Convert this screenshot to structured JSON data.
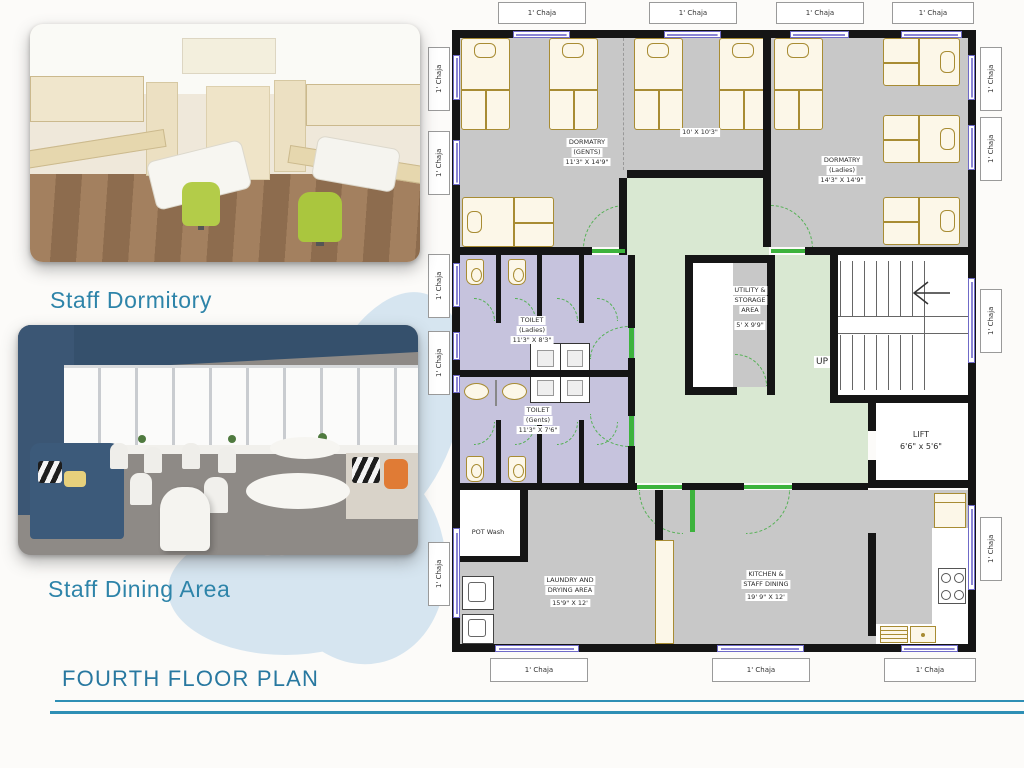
{
  "slide": {
    "captions": {
      "dormitory": "Staff Dormitory",
      "dining": "Staff Dining Area"
    },
    "title": "FOURTH FLOOR PLAN",
    "watermark": "a",
    "accent_color": "#2e84a9",
    "line_color": "#2e8fb5"
  },
  "plan": {
    "chaja": "1' Chaja",
    "up": "UP",
    "rooms": {
      "dorm_gents": {
        "name": "DORMATRY",
        "sub": "(GENTS)",
        "dims": "11'3\" X 14'9\""
      },
      "mid_room": {
        "dims": "10'  X 10'3\""
      },
      "dorm_ladies": {
        "name": "DORMATRY",
        "sub": "(Ladies)",
        "dims": "14'3\" X 14'9\""
      },
      "toilet_ladies": {
        "name": "TOILET",
        "sub": "(Ladies)",
        "dims": "11'3\" X 8'3\""
      },
      "toilet_gents": {
        "name": "TOILET",
        "sub": "(Gents)",
        "dims": "11'3\" X 7'6\""
      },
      "utility": {
        "l1": "UTILITY &",
        "l2": "STORAGE",
        "l3": "AREA",
        "dims": "5' X 9'9\""
      },
      "lift": {
        "name": "LIFT",
        "dims": "6'6\" x 5'6\""
      },
      "pot_wash": {
        "name": "POT Wash"
      },
      "laundry": {
        "l1": "LAUNDRY AND",
        "l2": "DRYING AREA",
        "dims": "15'9\" X 12'"
      },
      "kitchen": {
        "l1": "KITCHEN &",
        "l2": "STAFF DINING",
        "dims": "19' 9\" X 12'"
      }
    },
    "colors": {
      "floor": "#c8c8c8",
      "corridor": "#d9e8d2",
      "toilet": "#c6c3dd",
      "furniture": "#a88c33",
      "window": "#6f6ac8",
      "door": "#3db33d",
      "wall": "#151515"
    }
  }
}
